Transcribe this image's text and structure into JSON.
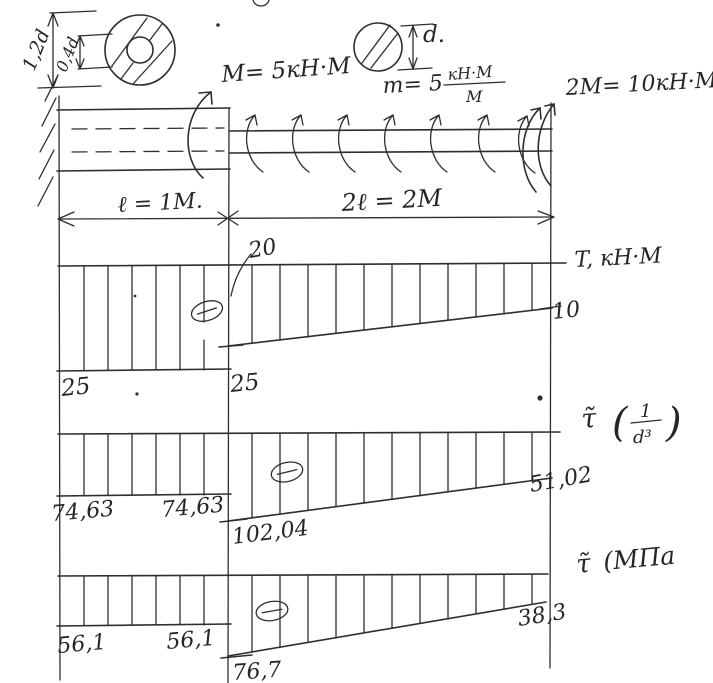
{
  "title": "Hand-drawn shaft torsion diagram sheet",
  "section_dims": {
    "outer": "1,2d",
    "inner": "0,4d",
    "solid": "d."
  },
  "loads": {
    "moment_left": "M= 5кН·М",
    "dist_prefix": "m= 5",
    "dist_num": "кН·М",
    "dist_den": "М",
    "moment_right": "2M= 10кН·М."
  },
  "lengths": {
    "left": "ℓ = 1М.",
    "right": "2ℓ = 2М"
  },
  "torque": {
    "label": "T, кН·М",
    "left": "25",
    "junction": "25",
    "peak": "20",
    "end": "10"
  },
  "tau_rel": {
    "tau": "τ̃",
    "open": "(",
    "num": "1",
    "den": "d³",
    "close": ")",
    "left": "74,63",
    "left2": "74,63",
    "junction": "102,04",
    "end": "51,02"
  },
  "tau_mpa": {
    "tau": "τ̃",
    "rest": "(МПа",
    "left": "56,1",
    "left2": "56,1",
    "junction": "76,7",
    "end": "38,3"
  },
  "chart_data": [
    {
      "type": "area",
      "title": "T, кН·М",
      "x": [
        0,
        1,
        1,
        3
      ],
      "values": [
        -25,
        -25,
        -20,
        -10
      ],
      "sign": "negative"
    },
    {
      "type": "area",
      "title": "τ (1/d³)",
      "x": [
        0,
        1,
        1,
        3
      ],
      "values": [
        -74.63,
        -74.63,
        -102.04,
        -51.02
      ],
      "sign": "negative"
    },
    {
      "type": "area",
      "title": "τ (МПа)",
      "x": [
        0,
        1,
        1,
        3
      ],
      "values": [
        -56.1,
        -56.1,
        -76.7,
        -38.3
      ],
      "sign": "negative"
    }
  ]
}
